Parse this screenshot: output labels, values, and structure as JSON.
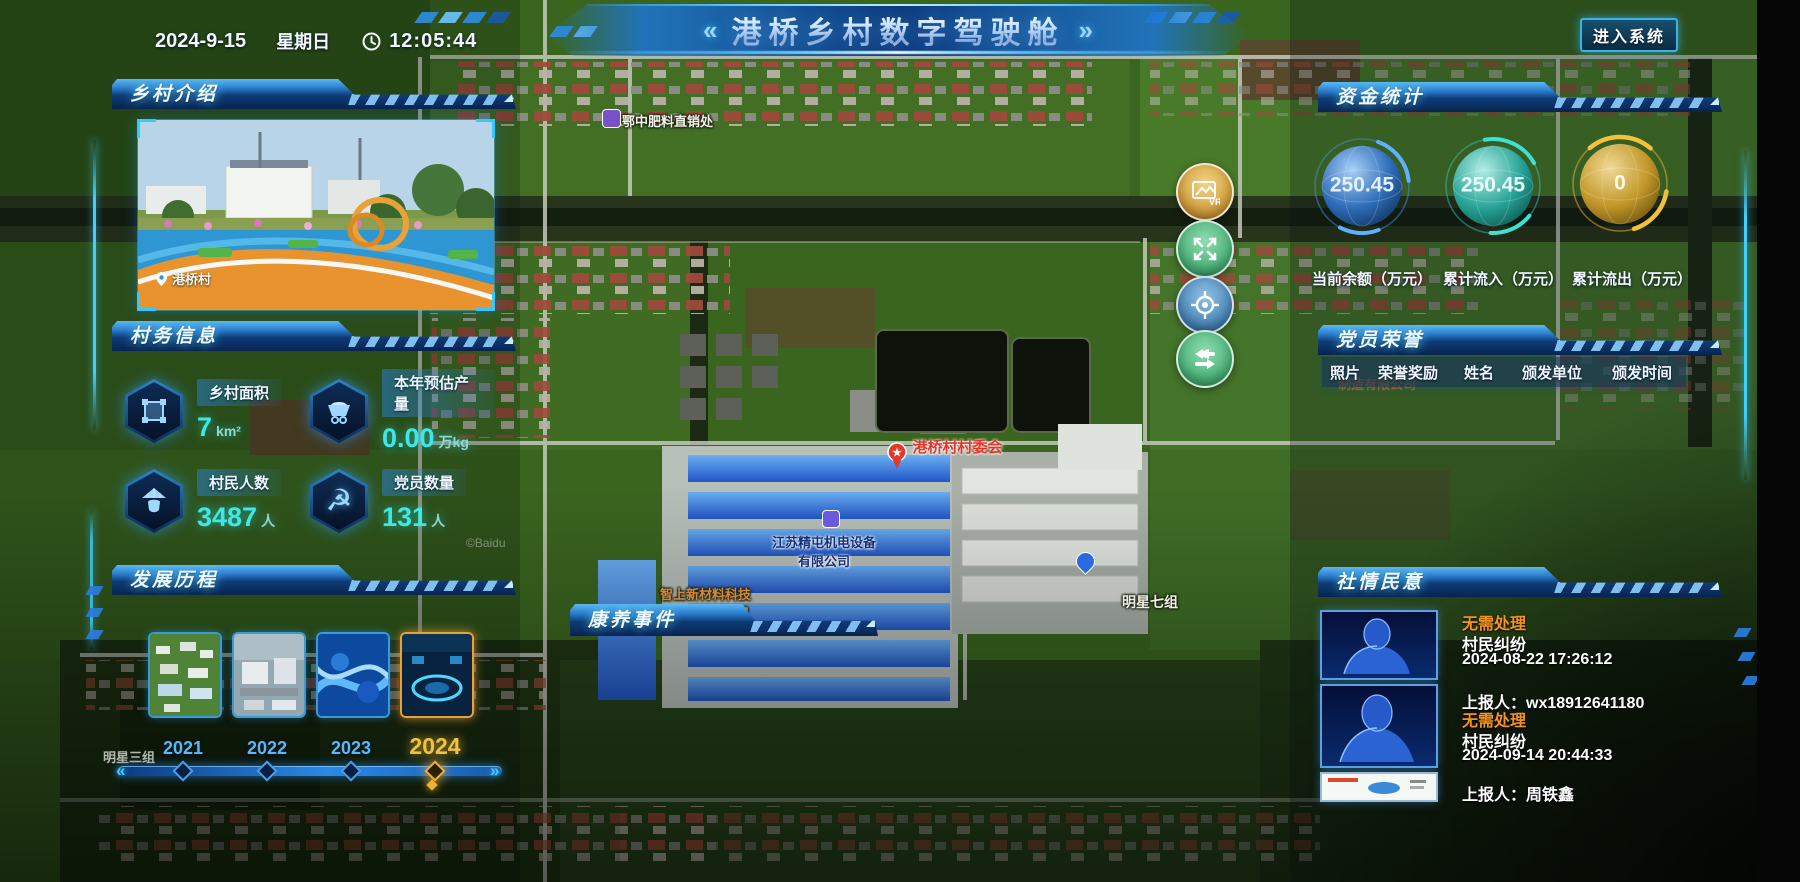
{
  "header": {
    "date": "2024-9-15",
    "weekday": "星期日",
    "time": "12:05:44",
    "chevron_left": "«",
    "chevron_right": "»",
    "title": "港桥乡村数字驾驶舱",
    "enter_button": "进入系统"
  },
  "intro": {
    "title": "乡村介绍",
    "photo_caption": "港桥村"
  },
  "affairs": {
    "title": "村务信息",
    "stats": [
      {
        "icon": "area-icon",
        "label": "乡村面积",
        "value": "7",
        "unit": "km²"
      },
      {
        "icon": "cart-icon",
        "label": "本年预估产量",
        "value": "0.00",
        "unit": "万kg"
      },
      {
        "icon": "villager-icon",
        "label": "村民人数",
        "value": "3487",
        "unit": "人"
      },
      {
        "icon": "party-icon",
        "label": "党员数量",
        "value": "131",
        "unit": "人"
      }
    ]
  },
  "history": {
    "title": "发展历程",
    "active_year": "2024",
    "years": [
      {
        "label": "2021"
      },
      {
        "label": "2022"
      },
      {
        "label": "2023"
      },
      {
        "label": "2024"
      }
    ]
  },
  "funds": {
    "title": "资金统计",
    "gauges": [
      {
        "value": "250.45",
        "label": "当前余额（万元）",
        "color": "#4a9ae8"
      },
      {
        "value": "250.45",
        "label": "累计流入（万元）",
        "color": "#35d0c0"
      },
      {
        "value": "0",
        "label": "累计流出（万元）",
        "color": "#e8b830"
      }
    ]
  },
  "honors": {
    "title": "党员荣誉",
    "columns": [
      "照片",
      "荣誉奖励",
      "姓名",
      "颁发单位",
      "颁发时间"
    ]
  },
  "opinions": {
    "title": "社情民意",
    "status_color": "#f7941e",
    "items": [
      {
        "status": "无需处理",
        "category": "村民纠纷",
        "time": "2024-08-22 17:26:12",
        "reporter": "上报人：wx18912641180"
      },
      {
        "status": "无需处理",
        "category": "村民纠纷",
        "time": "2024-09-14 20:44:33",
        "reporter": "上报人：周铁鑫"
      }
    ]
  },
  "health": {
    "title": "康养事件"
  },
  "map": {
    "labels": {
      "fertilizer": "鄂中肥料直销处",
      "committee": "港桥村村委会",
      "company1_line1": "江苏精屯机电设备",
      "company1_line2": "有限公司",
      "company2_line1": "智上新材料科技",
      "company2_line2": "(东台)有限公司",
      "factory_fragment": "制造有限公司",
      "group7": "明星七组",
      "group3": "明星三组",
      "watermark": "©Baidu"
    },
    "controls": [
      {
        "name": "vr-photo-button",
        "badge": "VR"
      },
      {
        "name": "expand-button"
      },
      {
        "name": "locate-button"
      },
      {
        "name": "switch-button"
      }
    ]
  }
}
